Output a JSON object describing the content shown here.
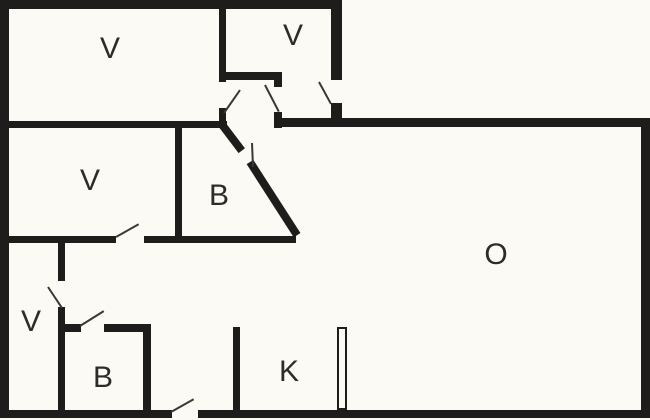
{
  "plan_title": "floor-plan",
  "colors": {
    "background": "#fbfaf5",
    "wall": "#1f1d1b",
    "label_text": "#2e2c29",
    "door_leaf": "#3a3835"
  },
  "rooms": [
    {
      "id": "room-v-top-left",
      "label": "V",
      "cx": 110,
      "cy": 49
    },
    {
      "id": "room-v-top-small",
      "label": "V",
      "cx": 293,
      "cy": 36
    },
    {
      "id": "room-v-mid-left",
      "label": "V",
      "cx": 90,
      "cy": 181
    },
    {
      "id": "room-b-middle",
      "label": "B",
      "cx": 219,
      "cy": 196
    },
    {
      "id": "room-v-corridor",
      "label": "V",
      "cx": 31,
      "cy": 322
    },
    {
      "id": "room-b-bottom",
      "label": "B",
      "cx": 103,
      "cy": 378
    },
    {
      "id": "room-k-kitchen",
      "label": "K",
      "cx": 289,
      "cy": 372
    },
    {
      "id": "room-o-living",
      "label": "O",
      "cx": 496,
      "cy": 255
    }
  ],
  "walls": [
    {
      "name": "outer-top",
      "x": 0,
      "y": 0,
      "w": 342,
      "h": 9
    },
    {
      "name": "outer-left",
      "x": 0,
      "y": 0,
      "w": 9,
      "h": 418
    },
    {
      "name": "outer-bottom-left",
      "x": 0,
      "y": 410,
      "w": 172,
      "h": 8
    },
    {
      "name": "outer-bottom-right",
      "x": 198,
      "y": 410,
      "w": 452,
      "h": 8
    },
    {
      "name": "outer-right",
      "x": 641,
      "y": 118,
      "w": 9,
      "h": 300
    },
    {
      "name": "outer-step-upper",
      "x": 331,
      "y": 0,
      "w": 11,
      "h": 80
    },
    {
      "name": "outer-step-lower",
      "x": 331,
      "y": 103,
      "w": 11,
      "h": 24
    },
    {
      "name": "o-room-top",
      "x": 274,
      "y": 118,
      "w": 376,
      "h": 9
    },
    {
      "name": "vtl-right-upper",
      "x": 219,
      "y": 9,
      "w": 7,
      "h": 73
    },
    {
      "name": "vtl-right-lower",
      "x": 219,
      "y": 108,
      "w": 7,
      "h": 20
    },
    {
      "name": "vtl-bottom",
      "x": 0,
      "y": 121,
      "w": 227,
      "h": 7
    },
    {
      "name": "vtop-small-bottom",
      "x": 219,
      "y": 72,
      "w": 63,
      "h": 8
    },
    {
      "name": "hall-mid-stub-upper",
      "x": 274,
      "y": 72,
      "w": 8,
      "h": 15
    },
    {
      "name": "hall-mid-stub-lower",
      "x": 274,
      "y": 112,
      "w": 8,
      "h": 16
    },
    {
      "name": "b-middle-left",
      "x": 175,
      "y": 121,
      "w": 7,
      "h": 122
    },
    {
      "name": "mid-horizontal-left",
      "x": 0,
      "y": 236,
      "w": 116,
      "h": 7
    },
    {
      "name": "mid-horizontal-right",
      "x": 144,
      "y": 236,
      "w": 152,
      "h": 7
    },
    {
      "name": "corridor-vert-upper",
      "x": 58,
      "y": 243,
      "w": 7,
      "h": 38
    },
    {
      "name": "corridor-vert-lower",
      "x": 58,
      "y": 307,
      "w": 7,
      "h": 105
    },
    {
      "name": "b-bottom-top-left",
      "x": 58,
      "y": 324,
      "w": 23,
      "h": 8
    },
    {
      "name": "b-bottom-top-right",
      "x": 104,
      "y": 324,
      "w": 47,
      "h": 8
    },
    {
      "name": "b-bottom-right",
      "x": 143,
      "y": 324,
      "w": 8,
      "h": 88
    },
    {
      "name": "k-partition",
      "x": 233,
      "y": 327,
      "w": 7,
      "h": 85
    }
  ],
  "diagonal_walls": [
    {
      "name": "b-diagonal-upper",
      "x1": 220,
      "y1": 122,
      "x2": 242,
      "y2": 151,
      "thickness": 8
    },
    {
      "name": "b-diagonal-lower",
      "x1": 250,
      "y1": 162,
      "x2": 297,
      "y2": 235,
      "thickness": 8
    }
  ],
  "door_leaves": [
    {
      "name": "door-hall-left",
      "x1": 224,
      "y1": 113,
      "x2": 240,
      "y2": 90
    },
    {
      "name": "door-hall-middle",
      "x1": 265,
      "y1": 85,
      "x2": 279,
      "y2": 112
    },
    {
      "name": "door-entry-top",
      "x1": 319,
      "y1": 82,
      "x2": 331,
      "y2": 104
    },
    {
      "name": "door-b-diagonal",
      "x1": 252,
      "y1": 143,
      "x2": 253,
      "y2": 167
    },
    {
      "name": "door-v-mid",
      "x1": 116,
      "y1": 237,
      "x2": 139,
      "y2": 224
    },
    {
      "name": "door-corridor",
      "x1": 48,
      "y1": 287,
      "x2": 62,
      "y2": 308
    },
    {
      "name": "door-b-bottom",
      "x1": 80,
      "y1": 326,
      "x2": 104,
      "y2": 311
    },
    {
      "name": "door-entry-bottom",
      "x1": 171,
      "y1": 412,
      "x2": 194,
      "y2": 399
    }
  ],
  "open_door_panels": [
    {
      "name": "door-panel-o-room",
      "x": 337,
      "y": 327,
      "w": 10,
      "h": 83
    }
  ]
}
